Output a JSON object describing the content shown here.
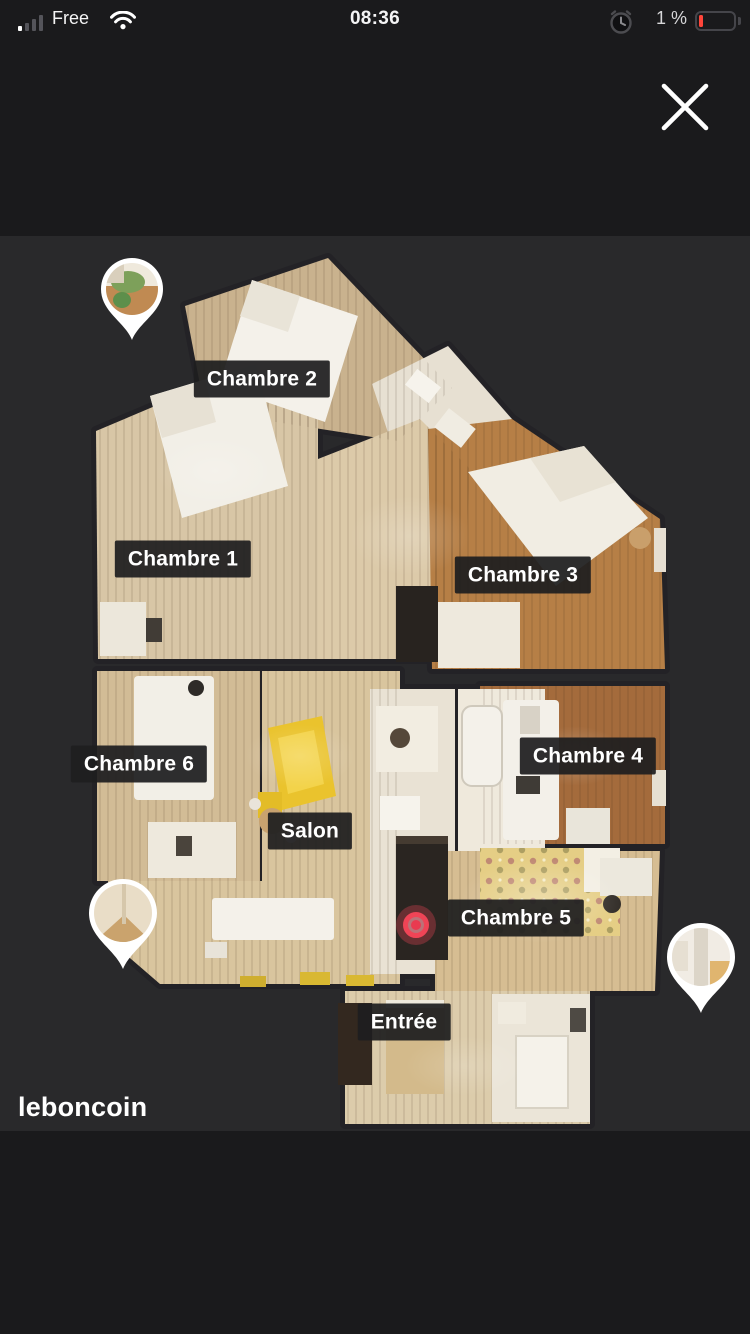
{
  "status_bar": {
    "carrier": "Free",
    "time": "08:36",
    "battery_level": "1 %",
    "signal_icon": "cellular-signal-1-of-4-bars",
    "wifi_icon": "wifi",
    "alarm_icon": "alarm-clock",
    "battery_icon": "battery-low-red"
  },
  "viewer": {
    "close_icon": "close-x",
    "watermark": "leboncoin",
    "floorplan": {
      "kind": "3d-dollhouse-top-view-floorplan",
      "labels": [
        {
          "text": "Chambre 2"
        },
        {
          "text": "Chambre 1"
        },
        {
          "text": "Chambre 3"
        },
        {
          "text": "Chambre 4"
        },
        {
          "text": "Chambre 6"
        },
        {
          "text": "Salon"
        },
        {
          "text": "Chambre 5"
        },
        {
          "text": "Entrée"
        }
      ],
      "photo_pins": [
        {
          "name": "photo-pin-balcony"
        },
        {
          "name": "photo-pin-room-left"
        },
        {
          "name": "photo-pin-room-right"
        }
      ],
      "position_marker_color": "#ef4456"
    }
  },
  "colors": {
    "top_bar_bg": "#1a1a1c",
    "viewer_bg": "#29292b",
    "label_bg": "#1e1e1f",
    "label_text": "#ffffff",
    "battery_warning": "#ff453a"
  }
}
